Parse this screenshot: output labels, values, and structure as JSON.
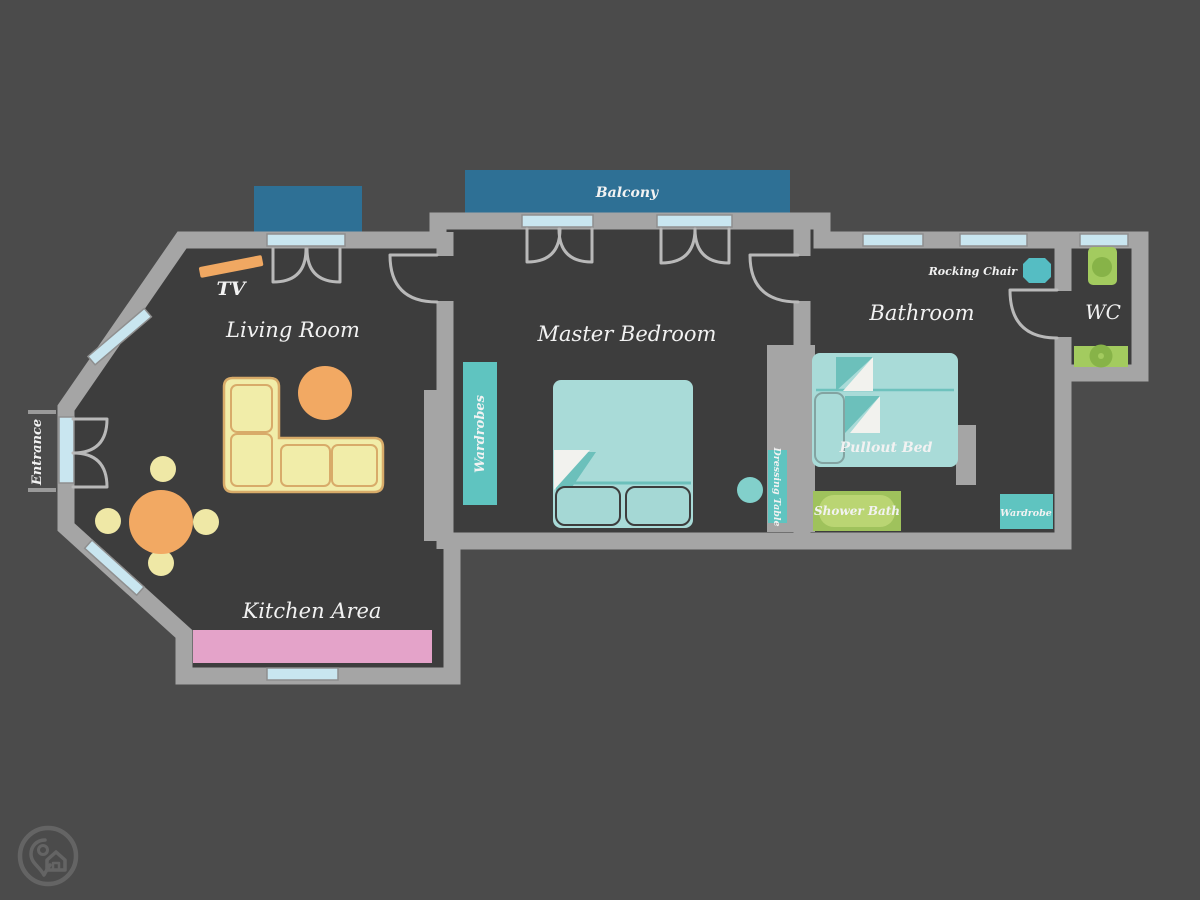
{
  "title": "Apartment floor plan",
  "rooms": {
    "living_room": "Living Room",
    "master_bedroom": "Master Bedroom",
    "bathroom": "Bathroom",
    "wc": "WC",
    "kitchen_area": "Kitchen Area"
  },
  "outdoor": {
    "balcony": "Balcony",
    "entrance": "Entrance"
  },
  "furniture": {
    "tv": "TV",
    "wardrobes": "Wardrobes",
    "dressing_table": "Dressing Table",
    "rocking_chair": "Rocking Chair",
    "pullout_bed": "Pullout Bed",
    "shower_bath": "Shower Bath",
    "wardrobe": "Wardrobe"
  },
  "colors": {
    "background": "#4b4b4b",
    "floor": "#3d3d3d",
    "wall": "#a5a5a5",
    "window": "#c9e6f0",
    "balcony_blue": "#2e7095",
    "teal_furniture": "#5fc4c0",
    "bed_teal": "#a9dbd8",
    "bed_fold_teal": "#6cc0bb",
    "green_fixture": "#a3cb5f",
    "green_fixture_dark": "#87b348",
    "shower_inner": "#bad573",
    "kitchen_counter_pink": "#e4a3c9",
    "sofa_yellow": "#f1eda9",
    "sofa_outline": "#d8ab69",
    "table_orange": "#f2a963",
    "chair_yellow": "#efe8a6",
    "tv_orange": "#f0a862",
    "label_text": "#f2f2f2"
  }
}
